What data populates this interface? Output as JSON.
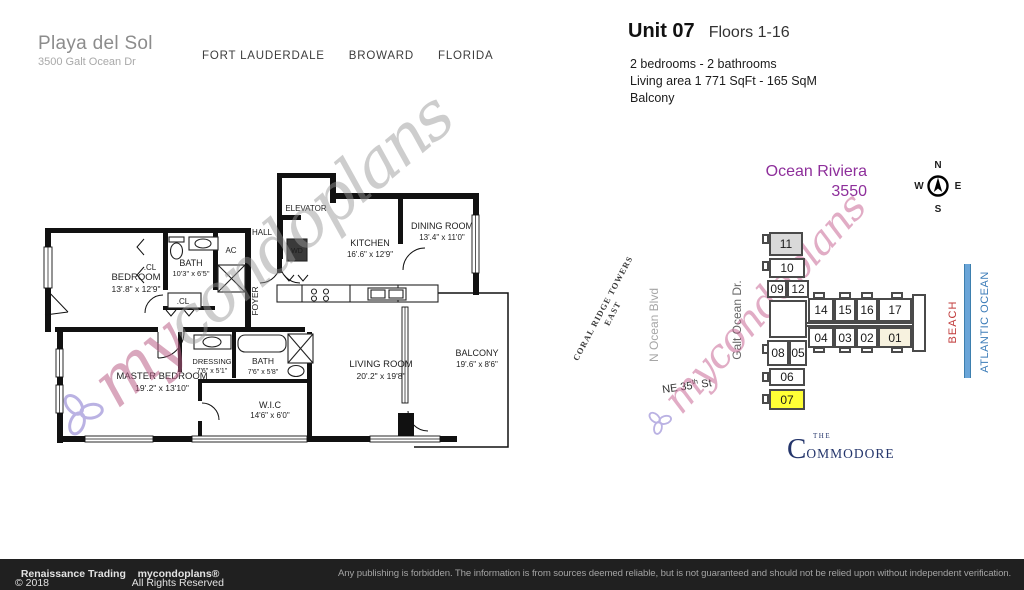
{
  "header": {
    "building_name": "Playa del Sol",
    "address": "3500 Galt Ocean Dr",
    "city": "FORT LAUDERDALE",
    "county": "BROWARD",
    "state": "FLORIDA"
  },
  "unit": {
    "title": "Unit 07",
    "floors": "Floors 1-16",
    "line1": "2 bedrooms - 2 bathrooms",
    "line2": "Living area 1 771  SqFt - 165 SqM",
    "line3": "Balcony"
  },
  "floorplan": {
    "rooms": [
      {
        "name": "BEDROOM",
        "dims": "13'.8\" x 12'9\""
      },
      {
        "name": "BATH",
        "dims": "10'3\" x 6'5\""
      },
      {
        "name": "MASTER BEDROOM",
        "dims": "19'.2\" x 13'10\""
      },
      {
        "name": "DRESSING",
        "dims": "7'6\" x 5'1\""
      },
      {
        "name": "BATH",
        "dims": "7'6\" x 5'8\""
      },
      {
        "name": "W.I.C",
        "dims": "14'6\" x 6'0\""
      },
      {
        "name": "KITCHEN",
        "dims": "16'.6\" x 12'9\""
      },
      {
        "name": "DINING ROOM",
        "dims": "13'.4\" x 11'0\""
      },
      {
        "name": "LIVING ROOM",
        "dims": "20'.2\" x 19'8\""
      },
      {
        "name": "BALCONY",
        "dims": "19'.6\" x 8'6\""
      }
    ],
    "labels": {
      "elevator": "ELEVATOR",
      "hall": "HALL",
      "ac": "AC",
      "wd": "WD",
      "foyer": "FOYER",
      "cl1": ".CL",
      "cl2": ".CL"
    }
  },
  "sitemap": {
    "building_name": "Ocean Riviera",
    "building_number": "3550",
    "compass": {
      "n": "N",
      "e": "E",
      "s": "S",
      "w": "W"
    },
    "streets": {
      "coral_ridge_line1": "CORAL RIDGE TOWERS",
      "coral_ridge_line2": "EAST",
      "n_ocean": "N Ocean Blvd",
      "galt_ocean": "Galt Ocean Dr.",
      "ne35_pre": "NE 35",
      "ne35_sup": "th",
      "ne35_post": " St"
    },
    "shore": {
      "beach": "BEACH",
      "ocean": "ATLANTIC OCEAN"
    },
    "units": {
      "u11": "11",
      "u10": "10",
      "u09": "09",
      "u12": "12",
      "u08": "08",
      "u05": "05",
      "u06": "06",
      "u07": "07",
      "u14": "14",
      "u15": "15",
      "u16": "16",
      "u17": "17",
      "u04": "04",
      "u03": "03",
      "u02": "02",
      "u01": "01"
    },
    "highlighted_unit": "07",
    "commodore": {
      "the": "THE",
      "c": "C",
      "rest": "OMMODORE"
    }
  },
  "watermark": {
    "prefix": "my",
    "suffix": "condoplans"
  },
  "footer": {
    "copyright": "© 2018",
    "company": "Renaissance Trading",
    "rights": "All Rights Reserved",
    "brand": "mycondoplans®",
    "disclaimer": "Any publishing is forbidden.  The information is from sources deemed reliable, but is not guaranteed and should not be relied upon without independent verification."
  },
  "colors": {
    "accent_purple": "#8e2f9b",
    "beach_red": "#c03a3a",
    "ocean_blue": "#3c7cb8",
    "highlight_yellow": "#ffff36",
    "footer_bg": "#202020"
  }
}
